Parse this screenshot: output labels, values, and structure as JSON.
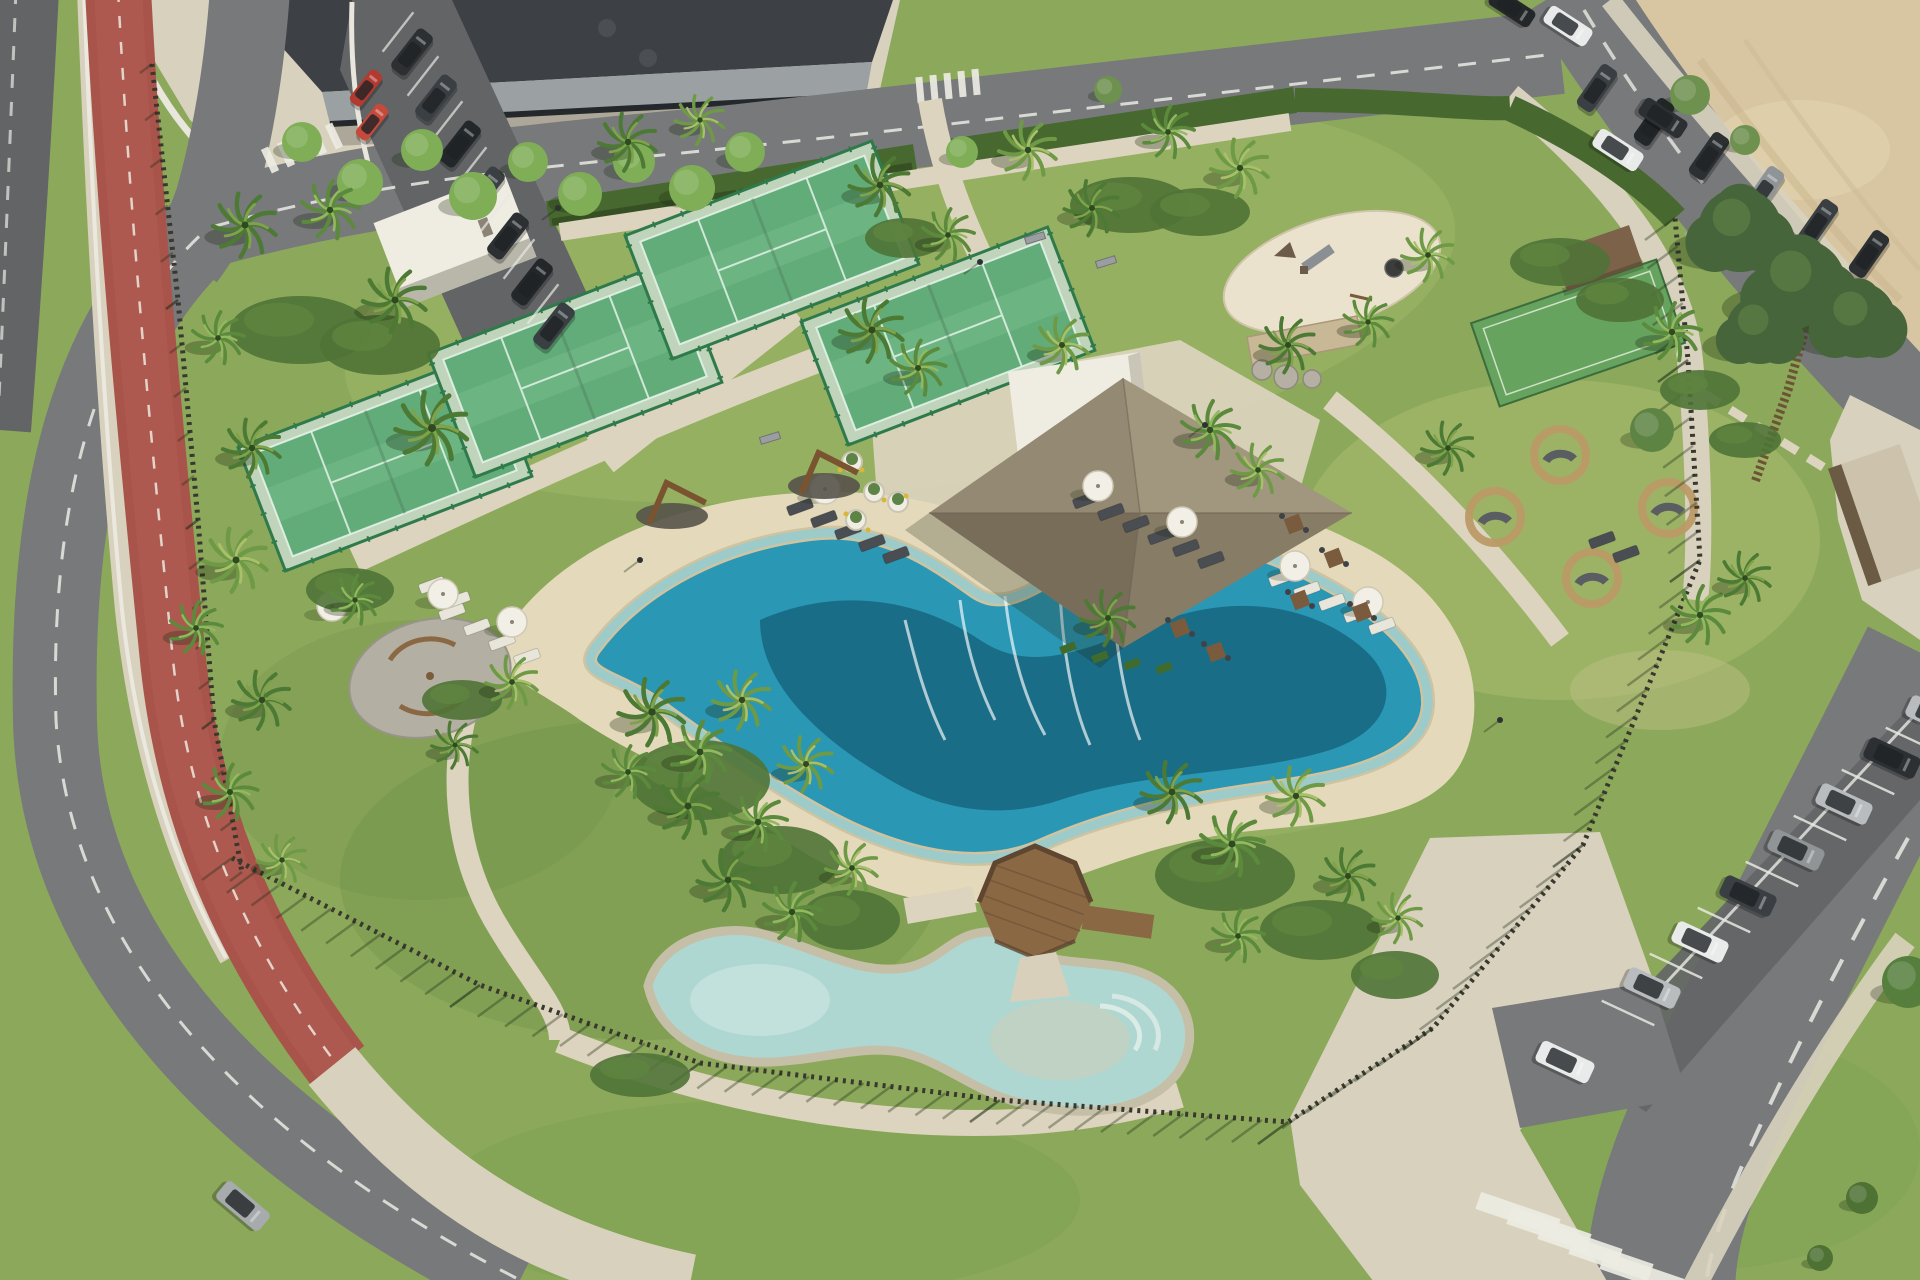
{
  "scene": {
    "label": "Aerial rendering of a coastal resort amenity park with padel courts, lagoon-style pool, kids pool, thatched pavilion, playground, red bike lane and street parking",
    "setting": "beachside community sports and leisure park",
    "time_of_day": "sunny daytime, long shadows to the lower-left",
    "features": [
      "four padel courts with green glass enclosures",
      "white storage building beside courts",
      "thatched-roof pavilion with white flat-roof bar building",
      "stone feature wall with boulders",
      "circular playground with slide",
      "lagoon swimming pool with sandy beach edge and waterfall jets",
      "kids pool connected by octagonal wooden deck bridge",
      "sun loungers and white parasols",
      "round rattan seating pods on lawn",
      "bocce / mini turf court with brown shade canopy",
      "gravel circle seating area with palms",
      "red bike lane along curving perimeter road",
      "angled street parking rows with cars",
      "zebra crosswalks",
      "sandy vacant lot at top right",
      "dark-roofed commercial building at top left",
      "wooden picket boundary fence with long shadows"
    ]
  },
  "inventory": {
    "padel_courts": 4,
    "pools": 2,
    "seating_pods": 4,
    "parasols": 8,
    "sun_loungers": 22,
    "palm_trees": 48,
    "parked_cars_top_left": 7,
    "red_vans_top_left": 2,
    "parked_cars_top_right": 8,
    "parked_cars_bottom_right": 8,
    "moving_cars": 3,
    "crosswalks": 3
  },
  "palette": {
    "grass": "#8CA95B",
    "grassLight": "#A9BE70",
    "grassDark": "#6B8A47",
    "hedge": "#47682F",
    "path": "#DCD4BE",
    "plaza": "#D8D1BE",
    "sandBeach": "#E4DABB",
    "sandWet": "#CFC3A0",
    "sandLot": "#D8C6A2",
    "road": "#77797B",
    "roadDark": "#626466",
    "redLane": "#A9544A",
    "redLaneLight": "#B5645A",
    "white": "#F2F0E8",
    "court": "#4D9F68",
    "courtLight": "#5FAE77",
    "courtFrame": "#2F7A4B",
    "glass": "#9ACFAA",
    "poolDeep": "#16657E",
    "poolMid": "#2A97B5",
    "poolLight": "#86CEDC",
    "kidsPool": "#AFD7D2",
    "thatchLight": "#A1967E",
    "thatchMid": "#948973",
    "thatchDark": "#877C66",
    "thatchDarker": "#776D59",
    "whiteBld": "#EFECE2",
    "wood": "#8A6844",
    "woodDark": "#5F4630",
    "fence": "#3A382E",
    "stone": "#C8B896",
    "gravel": "#B3AFA2",
    "umbrella": "#F2EFE6",
    "carDark1": "#2C3033",
    "carDark2": "#3A3F43",
    "carBlack": "#23272A",
    "carGray": "#8F9497",
    "carSilver": "#B9BCBE",
    "carWhite": "#E9EAEA",
    "carRed1": "#B23A30",
    "carRed2": "#C54A3C",
    "building": "#3D4146",
    "buildingWall": "#9BA1A3"
  }
}
